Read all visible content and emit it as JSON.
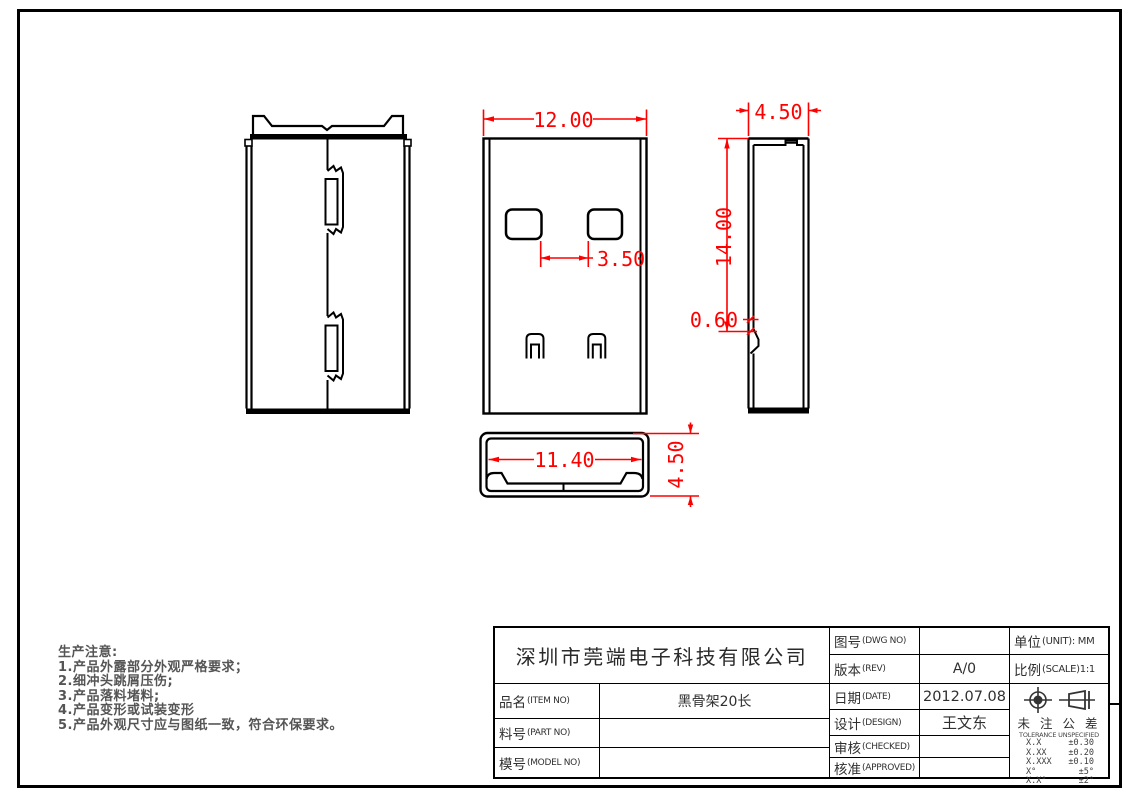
{
  "drawing": {
    "dims": {
      "front_width": "12.00",
      "hole_gap": "3.50",
      "side_width": "4.50",
      "side_height": "14.00",
      "lance_offset": "0.60",
      "bottom_inner_width": "11.40",
      "bottom_height": "4.50"
    },
    "dim_color": "#ff0000",
    "line_color": "#000000"
  },
  "notes": {
    "title": "生产注意:",
    "items": [
      "1.产品外露部分外观严格要求；",
      "2.细冲头跳屑压伤;",
      "3.产品落料堵料;",
      "4.产品变形或试装变形",
      "5.产品外观尺寸应与图纸一致，符合环保要求。"
    ]
  },
  "title_block": {
    "company": "深圳市莞端电子科技有限公司",
    "item": {
      "cn": "品名",
      "en": "(ITEM NO)",
      "value": "黑骨架20长"
    },
    "part": {
      "cn": "料号",
      "en": "(PART NO)",
      "value": ""
    },
    "model": {
      "cn": "模号",
      "en": "(MODEL NO)",
      "value": ""
    },
    "dwg": {
      "cn": "图号",
      "en": "(DWG NO)",
      "value": ""
    },
    "rev": {
      "cn": "版本",
      "en": "(REV)",
      "value": "A/0"
    },
    "date": {
      "cn": "日期",
      "en": "(DATE)",
      "value": "2012.07.08"
    },
    "design": {
      "cn": "设计",
      "en": "(DESIGN)",
      "value": "王文东"
    },
    "checked": {
      "cn": "审核",
      "en": "(CHECKED)",
      "value": ""
    },
    "approved": {
      "cn": "核准",
      "en": "(APPROVED)",
      "value": ""
    },
    "unit": {
      "cn": "单位",
      "en": "(UNIT): MM"
    },
    "scale": {
      "cn": "比例",
      "en": "(SCALE)1:1"
    },
    "tolerance": {
      "title_cn": "未 注 公 差",
      "title_en": "TOLERANCE UNSPECIFIED",
      "rows": [
        {
          "range": "X.X",
          "tol": "±0.30"
        },
        {
          "range": "X.XX",
          "tol": "±0.20"
        },
        {
          "range": "X.XXX",
          "tol": "±0.10"
        },
        {
          "range": "X°",
          "tol": "±5°"
        },
        {
          "range": "X.X°",
          "tol": "±2°"
        }
      ]
    }
  }
}
